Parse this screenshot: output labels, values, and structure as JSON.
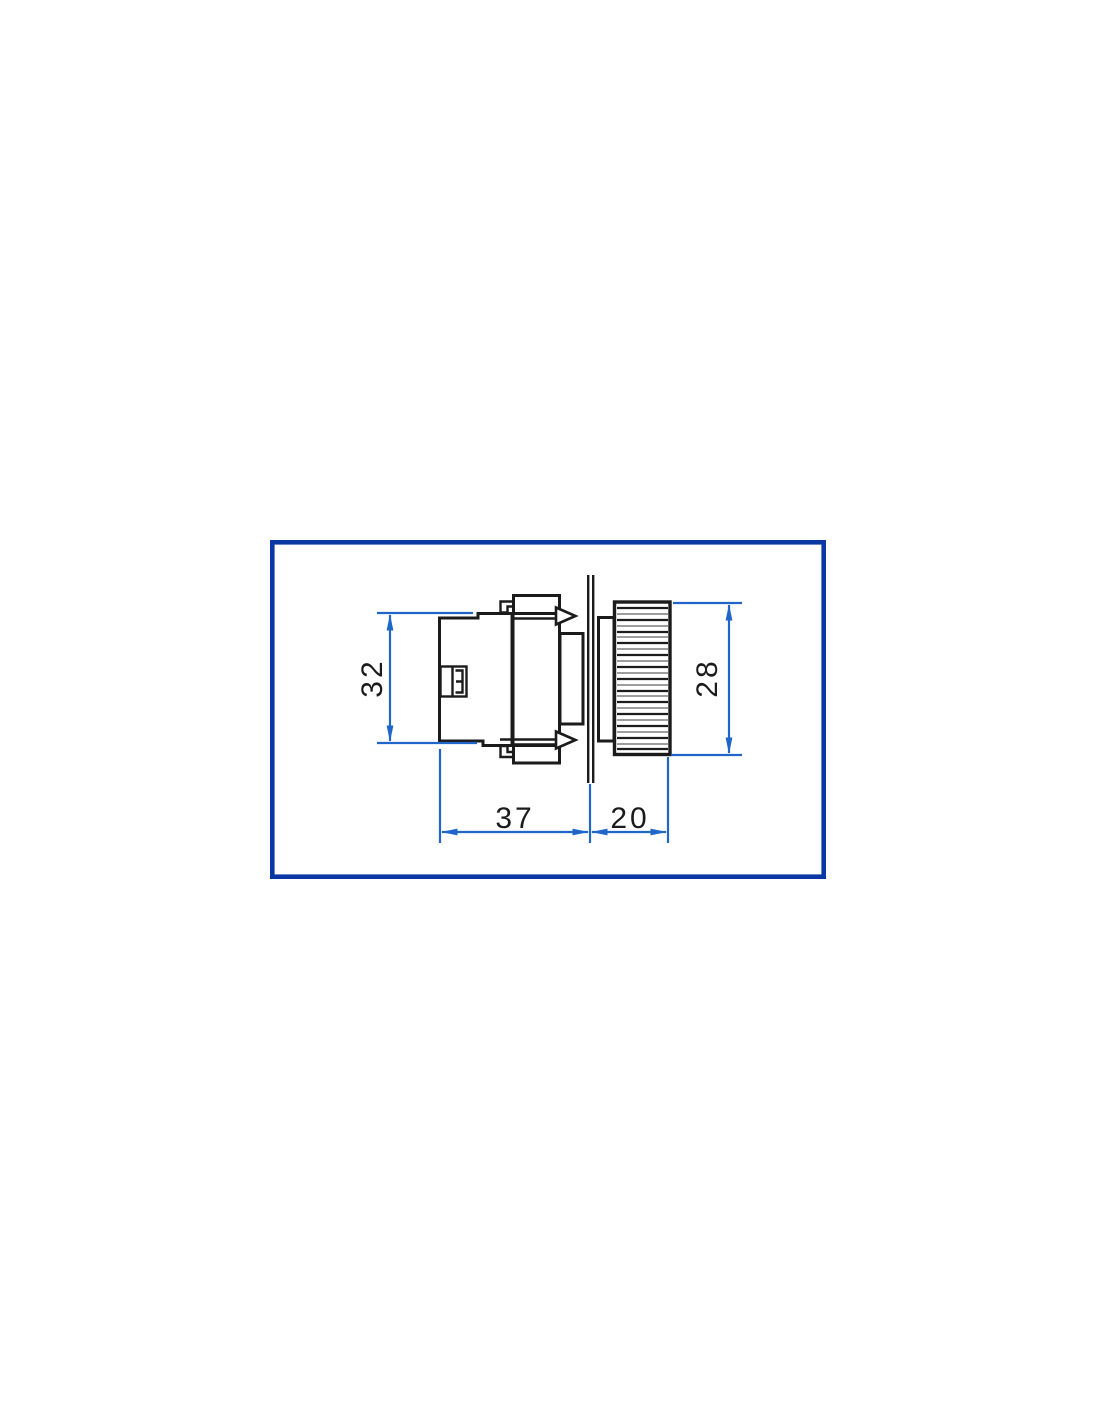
{
  "dimensions": {
    "body_height": "32",
    "head_diameter": "28",
    "body_depth": "37",
    "head_depth": "20"
  },
  "colors": {
    "frame_blue": "#0b37a4",
    "dimension_blue": "#2066c8",
    "linework_black": "#1b1b1b",
    "background": "#ffffff"
  }
}
